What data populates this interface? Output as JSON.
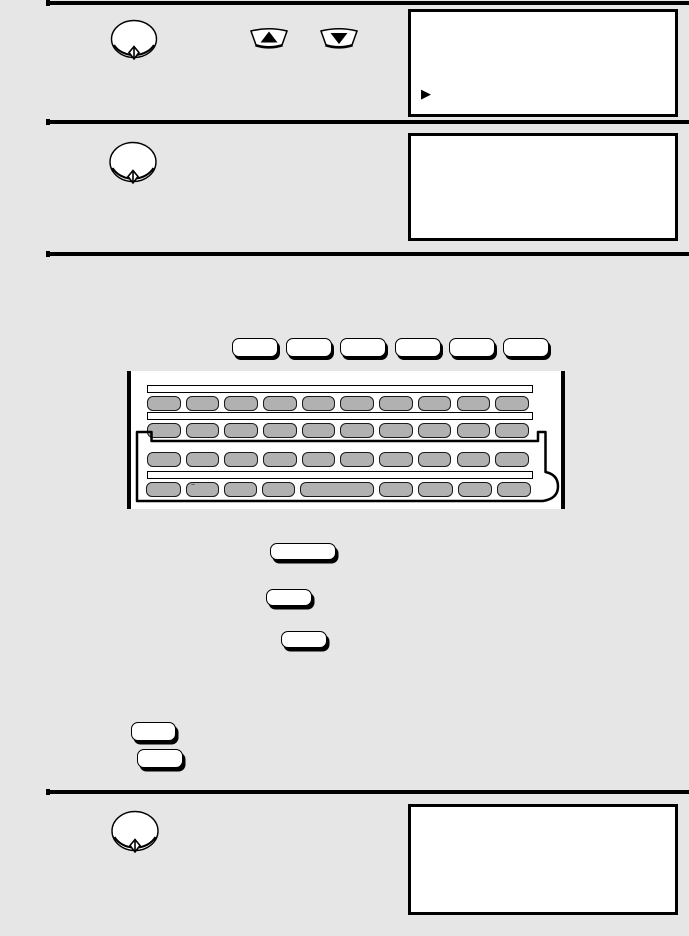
{
  "page": {
    "background_color": "#e6e6e6",
    "rule_color": "#000000",
    "panel_fill": "#ffffff",
    "key_fill_color": "#b1b1b1"
  },
  "icons": {
    "start_key": "diamond-start-icon",
    "up_key": "up-arrow-icon",
    "down_key": "down-arrow-icon",
    "display_cursor": "right-triangle-cursor"
  },
  "display_panels": [
    {
      "id": "panel-1",
      "cursor": "▶"
    },
    {
      "id": "panel-2",
      "cursor": ""
    },
    {
      "id": "panel-3",
      "cursor": ""
    }
  ],
  "keyboard": {
    "function_keys": [
      {},
      {},
      {},
      {},
      {},
      {}
    ],
    "rows": [
      {
        "keys": [
          {},
          {},
          {},
          {},
          {},
          {},
          {},
          {},
          {},
          {}
        ]
      },
      {
        "keys": [
          {},
          {},
          {},
          {},
          {},
          {},
          {},
          {},
          {},
          {}
        ]
      },
      {
        "keys": [
          {},
          {},
          {},
          {},
          {},
          {},
          {},
          {},
          {},
          {}
        ]
      },
      {
        "keys": [
          {
            "w": 35
          },
          {
            "w": 33,
            "mark": "~"
          },
          {
            "w": 33
          },
          {
            "w": 33
          },
          {
            "w": 74,
            "space": true
          },
          {
            "w": 34
          },
          {
            "w": 35
          },
          {
            "w": 34
          },
          {
            "w": 34
          }
        ]
      }
    ]
  },
  "standalone_buttons": [
    {
      "id": "button-1"
    },
    {
      "id": "button-2"
    },
    {
      "id": "button-3"
    },
    {
      "id": "button-4"
    },
    {
      "id": "button-5"
    }
  ]
}
